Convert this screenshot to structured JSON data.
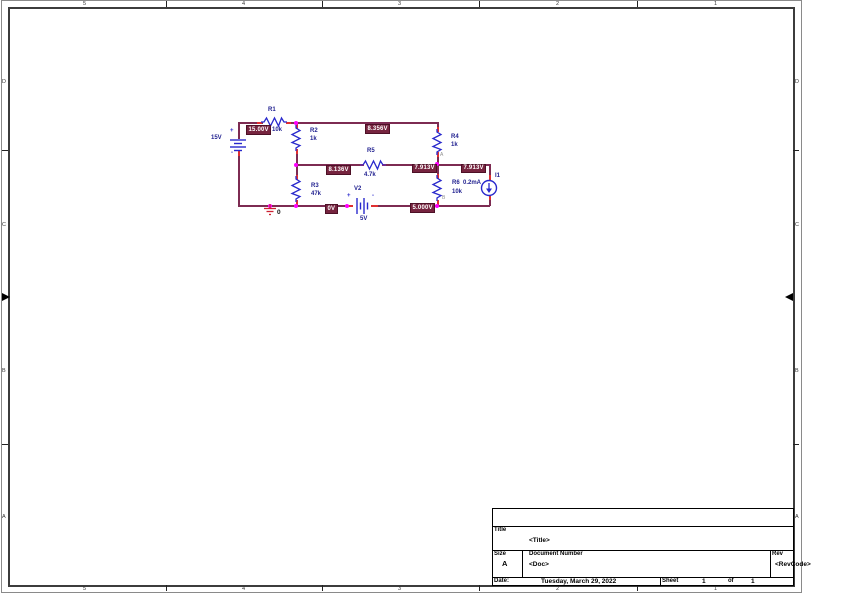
{
  "sheet": {
    "top_ruler": [
      "5",
      "4",
      "3",
      "2",
      "1"
    ],
    "bottom_ruler": [
      "5",
      "4",
      "3",
      "2",
      "1"
    ],
    "left_ruler": [
      "D",
      "C",
      "B",
      "A"
    ],
    "right_ruler": [
      "D",
      "C",
      "B",
      "A"
    ]
  },
  "circuit": {
    "sources": {
      "v1": {
        "value": "15V",
        "plus": "+",
        "minus": "-"
      },
      "v2": {
        "ref": "V2",
        "value": "5V",
        "plus": "+",
        "minus": "-"
      },
      "i1": {
        "ref": "I1",
        "value": "0.2mA"
      }
    },
    "resistors": {
      "r1": {
        "ref": "R1",
        "value": "10k"
      },
      "r2": {
        "ref": "R2",
        "value": "1k"
      },
      "r3": {
        "ref": "R3",
        "value": "47k"
      },
      "r4": {
        "ref": "R4",
        "value": "1k"
      },
      "r5": {
        "ref": "R5",
        "value": "4.7k"
      },
      "r6": {
        "ref": "R6",
        "value": "10k"
      }
    },
    "ground_label": "0",
    "node_labels": {
      "a": "A",
      "b": "B"
    },
    "bias_voltages": {
      "source_node": "15.00V",
      "top_node": "8.356V",
      "mid_left_node": "8.136V",
      "mid_right_node": "7.913V",
      "i1_branch_node": "7.913V",
      "bottom_left_node": "0V",
      "bottom_right_node": "5.000V"
    },
    "colors": {
      "wire": "#7D2B52",
      "bias_label_bg": "#76243F",
      "component_blue": "#2929CC",
      "designator_text": "#1F1F8F",
      "junction_dot": "#FF00FF",
      "pin_red": "#E03030"
    }
  },
  "title_block": {
    "title_label": "Title",
    "title_value": "<Title>",
    "size_label": "Size",
    "size_value": "A",
    "document_number_label": "Document Number",
    "document_number_value": "<Doc>",
    "rev_label": "Rev",
    "rev_value": "<RevCode>",
    "date_label": "Date:",
    "date_value": "Tuesday, March 29, 2022",
    "sheet_label": "Sheet",
    "sheet_number": "1",
    "of_label": "of",
    "sheet_total": "1"
  }
}
